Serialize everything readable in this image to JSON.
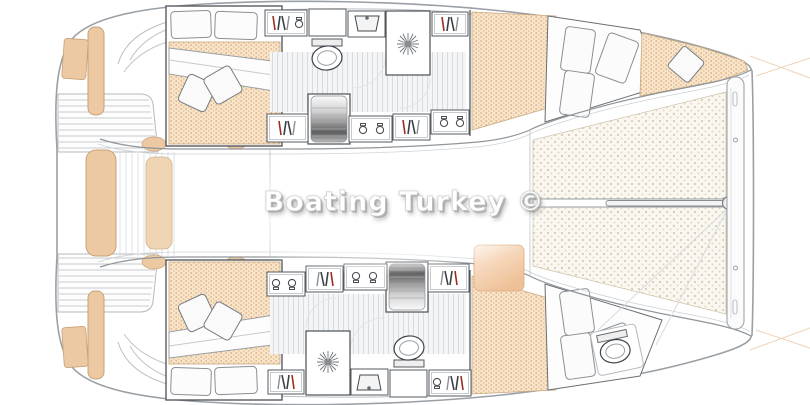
{
  "watermark": {
    "text": "Boating Turkey ©"
  },
  "drawing": {
    "type": "catamaran-interior-floor-plan",
    "view": "top-down",
    "hulls": [
      "port-hull-top",
      "starboard-hull-bottom"
    ],
    "rooms": [
      "aft-cabin",
      "bathroom",
      "corridor",
      "forward-cabin",
      "saloon",
      "cockpit",
      "forepeak"
    ],
    "fixtures": [
      "double-bed",
      "pillows",
      "duvet",
      "mattress",
      "wardrobe-locker",
      "storage-cupboard",
      "sink",
      "shower",
      "toilet",
      "companionway-stairs"
    ],
    "deck_features": [
      "swim-platform",
      "transom-seat",
      "cockpit-bench",
      "deck-planking",
      "trampoline",
      "bowsprit",
      "forward-crossbeam",
      "bow-guide-lines"
    ]
  },
  "colors": {
    "hull_outline": "#9aa0a5",
    "furniture_outline": "#4a4f55",
    "mattress_fill": "#f7e4ca",
    "mattress_dot": "#d9a26a",
    "cushion_fill": "#ecc9a3",
    "trampoline_fill": "#faf7f0",
    "trampoline_dot": "#d9ccb6",
    "stairs_dark": "#5f5f5f",
    "hanger_red": "#9b2c20",
    "guide_line": "#e2b488",
    "watermark_text": "#ffffff",
    "watermark_shadow": "#969696"
  }
}
